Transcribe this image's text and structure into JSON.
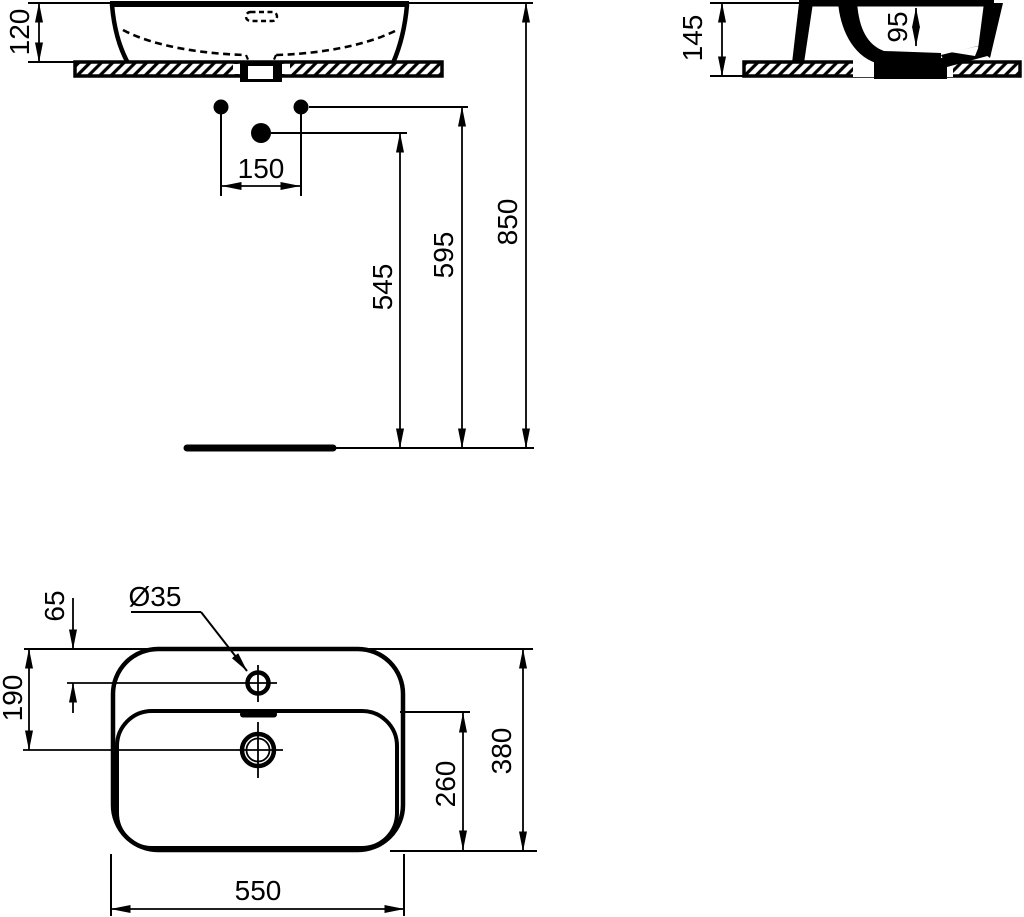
{
  "views": {
    "front": {
      "basin_height": "120",
      "hole_spacing": "150",
      "trap_height": "545",
      "holes_height": "595",
      "rim_height": "850"
    },
    "side": {
      "overall_height": "145",
      "bowl_depth": "95"
    },
    "plan": {
      "tap_hole_diameter": "Ø35",
      "tap_hole_offset": "65",
      "drain_offset": "190",
      "bowl_length": "260",
      "overall_depth": "380",
      "overall_width": "550"
    }
  }
}
